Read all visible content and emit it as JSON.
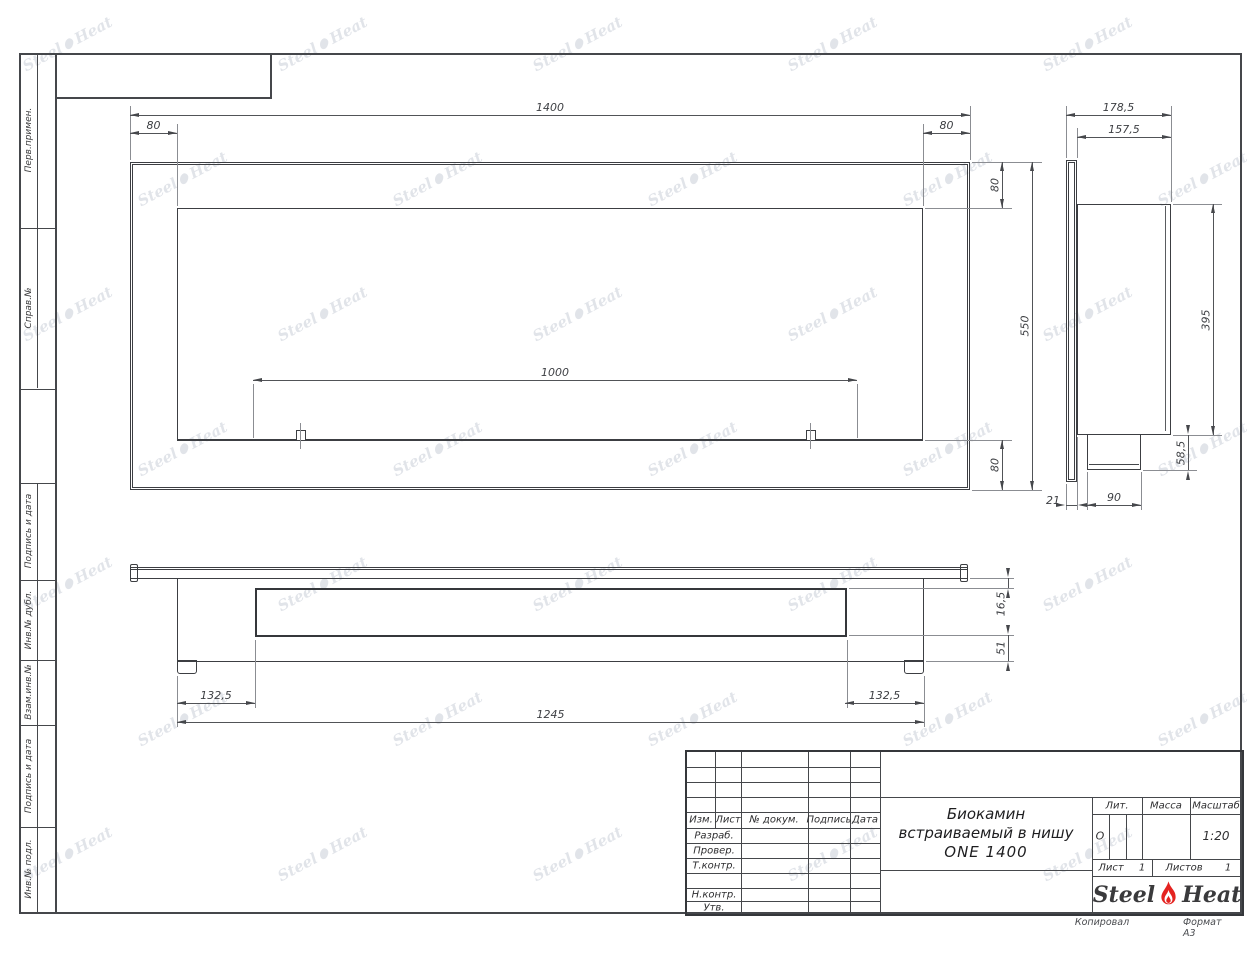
{
  "margin_labels": {
    "perv": "Перв.примен.",
    "sprav": "Справ.№",
    "podp1": "Подпись и дата",
    "inv_dubl": "Инв.№ дубл.",
    "vzam": "Взам.инв.№",
    "podp2": "Подпись и дата",
    "inv_podl": "Инв.№ подл."
  },
  "dimensions": {
    "front": {
      "total_width": "1400",
      "inset_left": "80",
      "inset_right": "80",
      "top_height": "80",
      "total_height": "550",
      "bottom_height": "80",
      "burner_width": "1000"
    },
    "side": {
      "depth_total": "178,5",
      "depth_body": "157,5",
      "body_height": "395",
      "box_height": "58,5",
      "flange_depth": "21",
      "box_depth": "90"
    },
    "bottom": {
      "lip": "16,5",
      "foot": "51",
      "offset_left": "132,5",
      "body_width": "1245",
      "offset_right": "132,5"
    }
  },
  "title_block": {
    "columns": {
      "izm": "Изм.",
      "list": "Лист",
      "doc": "№ докум.",
      "sign": "Подпись",
      "date": "Дата"
    },
    "rows": {
      "razrab": "Разраб.",
      "prover": "Провер.",
      "tkontr": "Т.контр.",
      "nkontr": "Н.контр.",
      "utv": "Утв."
    },
    "name_line1": "Биокамин",
    "name_line2": "встраиваемый в нишу",
    "name_line3": "ONE 1400",
    "right": {
      "lit_label": "Лит.",
      "massa_label": "Масса",
      "scale_label": "Масштаб",
      "lit_value": "О",
      "scale_value": "1:20",
      "sheet_label": "Лист",
      "sheet_value": "1",
      "sheets_label": "Листов",
      "sheets_value": "1"
    },
    "logo": {
      "part1": "Steel",
      "part2": "Heat"
    },
    "footer": {
      "copied": "Копировал",
      "format": "Формат А3"
    }
  },
  "watermark": {
    "part1": "Steel",
    "part2": "Heat"
  }
}
